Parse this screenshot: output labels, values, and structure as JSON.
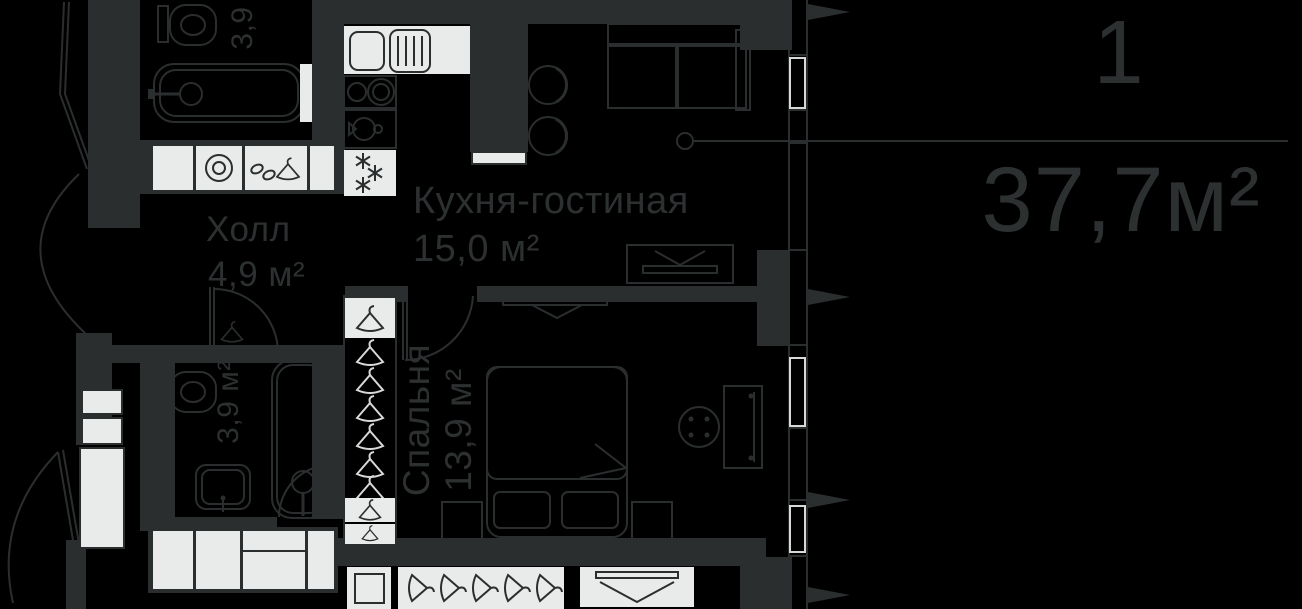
{
  "unit": {
    "rooms_count": "1",
    "total_area": "37,7м²"
  },
  "rooms": {
    "kitchen_living": {
      "name": "Кухня-гостиная",
      "area": "15,0 м²"
    },
    "hall": {
      "name": "Холл",
      "area": "4,9 м²"
    },
    "bedroom": {
      "name": "Спальня",
      "area": "13,9 м²"
    },
    "bathroom_top": {
      "area": "3,9"
    },
    "bathroom_bottom": {
      "area": "3,9 м²"
    }
  },
  "icons": [
    "toilet-icon",
    "bathtub-icon",
    "sink-icon",
    "washer-icon",
    "hanger-icon",
    "stove-icon",
    "fridge-snowflake-icon",
    "kettle-icon",
    "sofa-icon",
    "bed-icon",
    "tv-icon",
    "door-arc-icon",
    "window-icon",
    "facade-fin-icon",
    "dining-island-icon",
    "chair-icon",
    "wardrobe-icon",
    "mirror-icon"
  ],
  "colors": {
    "background": "#000000",
    "line": "#2b2e2f",
    "text": "#2d3031",
    "fixture_white": "#e9eaea"
  }
}
